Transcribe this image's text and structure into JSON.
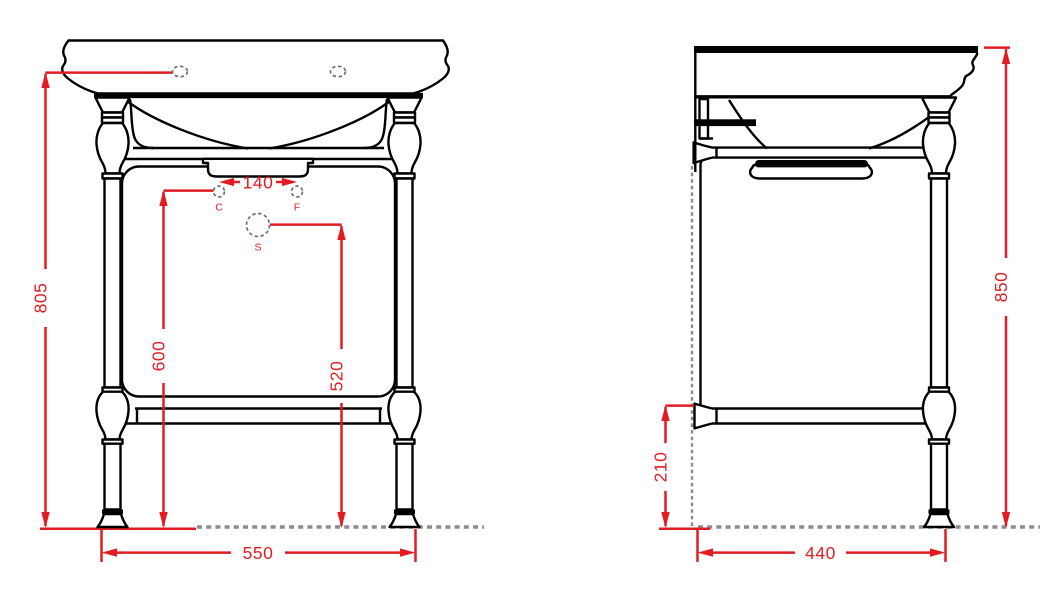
{
  "colors": {
    "background": "#ffffff",
    "outline": "#000000",
    "dimension": "#e11d23",
    "ground": "#8c8c8c",
    "holemark": "#6e6e6e"
  },
  "front_view": {
    "dimensions": {
      "overall_height": "805",
      "tap_holes_height": "600",
      "drain_height": "520",
      "overall_width": "550",
      "tap_hole_spacing": "140"
    },
    "hole_labels": {
      "c": "C",
      "f": "F",
      "s": "S"
    }
  },
  "side_view": {
    "dimensions": {
      "overall_height": "850",
      "shelf_height": "210",
      "overall_depth": "440"
    }
  }
}
